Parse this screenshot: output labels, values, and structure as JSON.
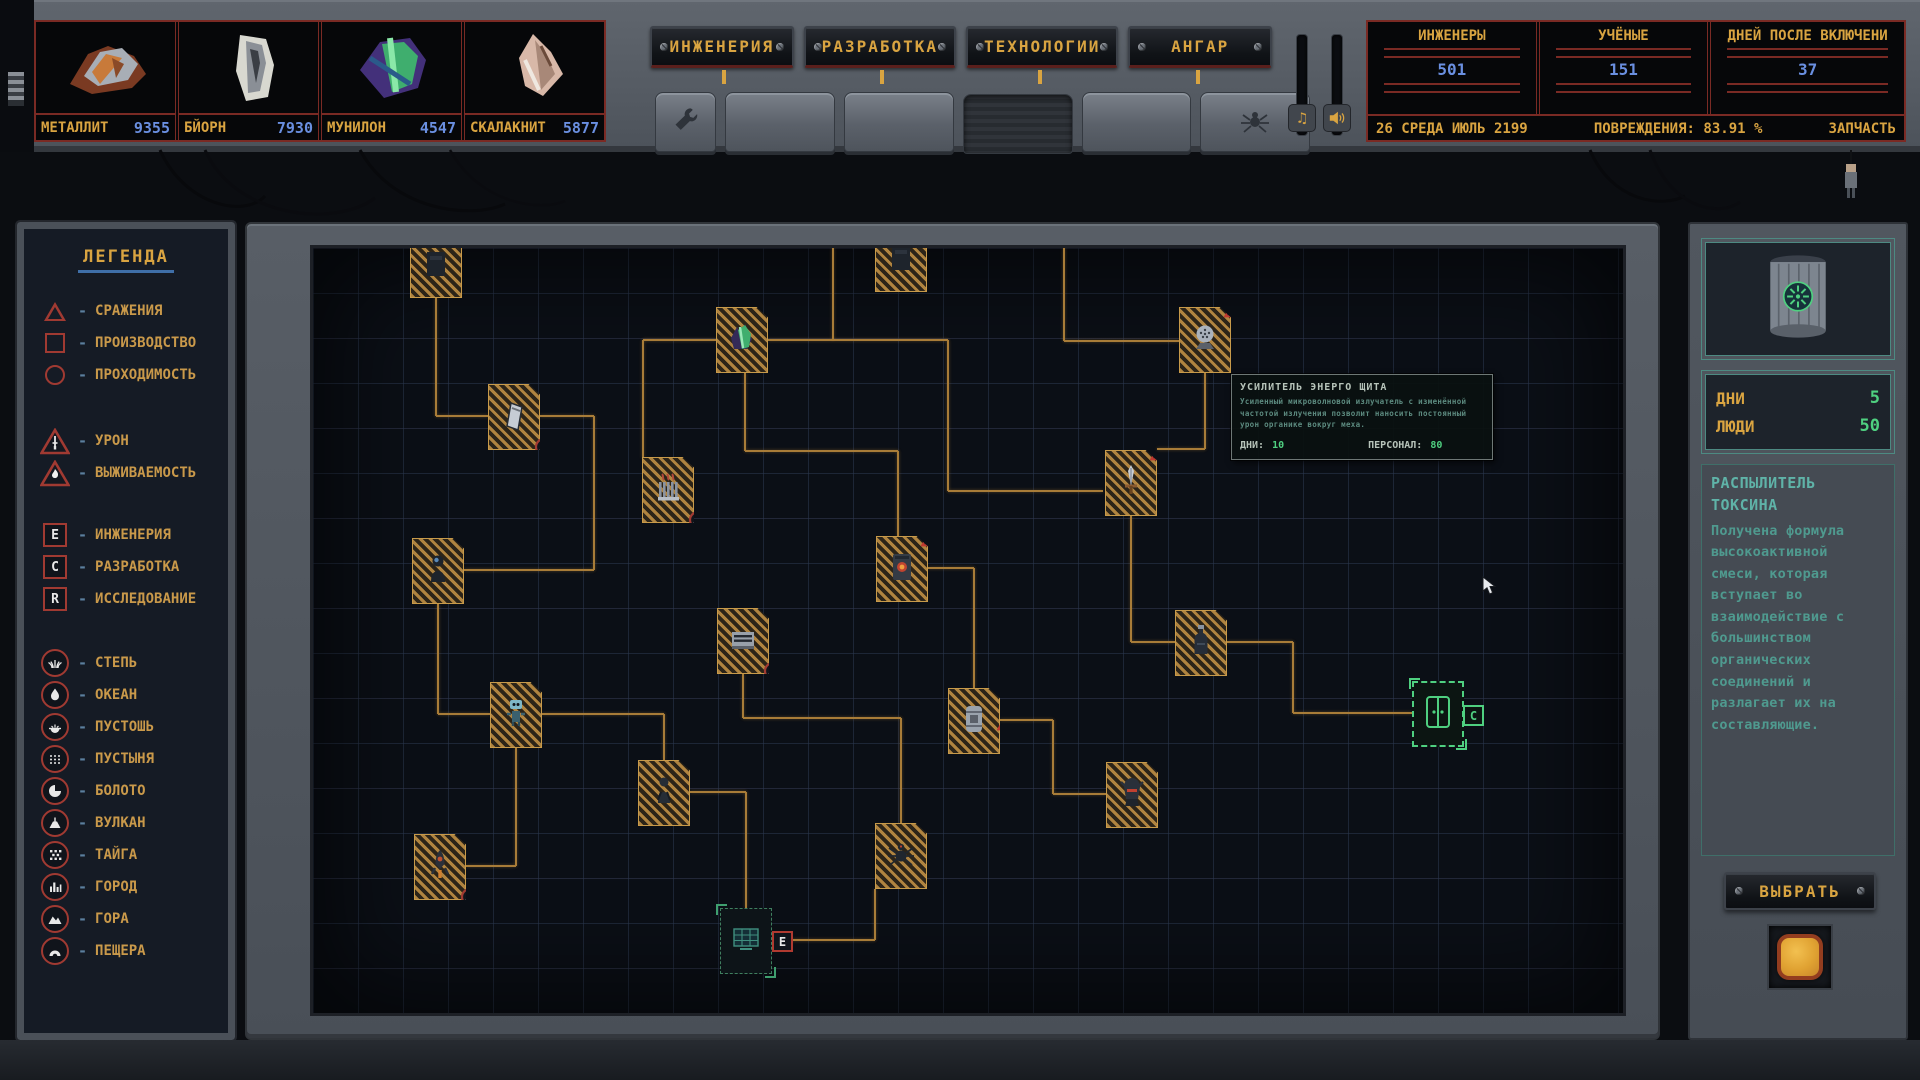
{
  "colors": {
    "accent_gold": "#d9a441",
    "value_blue": "#6a8fe0",
    "alert_red": "#a03a32",
    "teal_text": "#4f9a8f",
    "green_value": "#4fd080",
    "connector_orange": "#a87c38"
  },
  "resources": {
    "items": [
      {
        "name": "МЕТАЛЛИТ",
        "value": "9355",
        "icon": "metallit-ore-icon"
      },
      {
        "name": "БЙОРН",
        "value": "7930",
        "icon": "bjorn-ore-icon"
      },
      {
        "name": "МУНИЛОН",
        "value": "4547",
        "icon": "munilon-crystal-icon"
      },
      {
        "name": "СКАЛАКНИТ",
        "value": "5877",
        "icon": "skalaknit-shard-icon"
      }
    ]
  },
  "tabs": {
    "items": [
      {
        "label": "ИНЖЕНЕРИЯ"
      },
      {
        "label": "РАЗРАБОТКА"
      },
      {
        "label": "ТЕХНОЛОГИИ"
      },
      {
        "label": "АНГАР"
      }
    ]
  },
  "toolbar": {
    "keys": [
      {
        "icon": "wrench-icon",
        "narrow": true
      },
      {
        "icon": ""
      },
      {
        "icon": ""
      },
      {
        "icon": "",
        "pressed": true
      },
      {
        "icon": ""
      },
      {
        "icon": "spider-icon"
      }
    ]
  },
  "audio": {
    "music_icon": "music-note-icon",
    "music_glyph": "♫",
    "sfx_icon": "speaker-icon"
  },
  "stats": {
    "cols": [
      {
        "label": "ИНЖЕНЕРЫ",
        "value": "501"
      },
      {
        "label": "УЧЁНЫЕ",
        "value": "151"
      },
      {
        "label": "ДНЕЙ ПОСЛЕ ВКЛЮЧЕНИ",
        "value": "37"
      }
    ],
    "status": {
      "date": "26 СРЕДА ИЮЛЬ 2199",
      "damage_label": "ПОВРЕЖДЕНИЯ:",
      "damage_value": "83.91 %",
      "spare_label": "ЗАПЧАСТЬ"
    }
  },
  "legend": {
    "title": "ЛЕГЕНДА",
    "shape_items": [
      {
        "shape": "triangle",
        "label": "СРАЖЕНИЯ"
      },
      {
        "shape": "square",
        "label": "ПРОИЗВОДСТВО"
      },
      {
        "shape": "circle",
        "label": "ПРОХОДИМОСТЬ"
      }
    ],
    "alert_items": [
      {
        "icon": "sword-triangle-icon",
        "label": "УРОН"
      },
      {
        "icon": "flame-triangle-icon",
        "label": "ВЫЖИВАЕМОСТЬ"
      }
    ],
    "letter_items": [
      {
        "letter": "E",
        "label": "ИНЖЕНЕРИЯ"
      },
      {
        "letter": "C",
        "label": "РАЗРАБОТКА"
      },
      {
        "letter": "R",
        "label": "ИССЛЕДОВАНИЕ"
      }
    ],
    "biome_items": [
      {
        "icon": "steppe-icon",
        "label": "СТЕПЬ"
      },
      {
        "icon": "ocean-icon",
        "label": "ОКЕАН"
      },
      {
        "icon": "wasteland-icon",
        "label": "ПУСТОШЬ"
      },
      {
        "icon": "desert-icon",
        "label": "ПУСТЫНЯ"
      },
      {
        "icon": "swamp-icon",
        "label": "БОЛОТО"
      },
      {
        "icon": "volcano-icon",
        "label": "ВУЛКАН"
      },
      {
        "icon": "taiga-icon",
        "label": "ТАЙГА"
      },
      {
        "icon": "city-icon",
        "label": "ГОРОД"
      },
      {
        "icon": "mountain-icon",
        "label": "ГОРА"
      },
      {
        "icon": "cave-icon",
        "label": "ПЕЩЕРА"
      }
    ]
  },
  "map": {
    "nodes": [
      {
        "id": "node-top-module-1",
        "icon": "module",
        "x": 97,
        "y": -16,
        "badge": "none",
        "state": "normal"
      },
      {
        "id": "node-top-module-2",
        "icon": "module",
        "x": 562,
        "y": -22,
        "badge": "none",
        "state": "normal"
      },
      {
        "id": "node-crystal",
        "icon": "crystal",
        "x": 403,
        "y": 59,
        "badge": "c",
        "state": "normal"
      },
      {
        "id": "node-hatch",
        "icon": "hatch",
        "x": 175,
        "y": 136,
        "badge": "volcano",
        "state": "normal"
      },
      {
        "id": "node-radiator",
        "icon": "radiator",
        "x": 329,
        "y": 209,
        "badge": "volcano",
        "state": "normal"
      },
      {
        "id": "node-astronaut",
        "icon": "astronaut",
        "x": 99,
        "y": 290,
        "badge": "c",
        "state": "normal"
      },
      {
        "id": "node-server",
        "icon": "server",
        "x": 404,
        "y": 360,
        "badge": "volcano",
        "state": "normal"
      },
      {
        "id": "node-robot",
        "icon": "robot",
        "x": 177,
        "y": 434,
        "badge": "c",
        "state": "normal"
      },
      {
        "id": "node-worker",
        "icon": "worker",
        "x": 325,
        "y": 512,
        "badge": "e",
        "state": "normal"
      },
      {
        "id": "node-rocket",
        "icon": "rocket",
        "x": 101,
        "y": 586,
        "badge": "volcano",
        "state": "normal"
      },
      {
        "id": "node-furnace",
        "icon": "furnace",
        "x": 563,
        "y": 288,
        "badge": "warning",
        "state": "normal"
      },
      {
        "id": "node-spider-drone",
        "icon": "spider",
        "x": 562,
        "y": 575,
        "badge": "e",
        "state": "normal"
      },
      {
        "id": "node-solar-panel",
        "icon": "solar",
        "x": 407,
        "y": 660,
        "badge": "e",
        "state": "dim"
      },
      {
        "id": "node-barrel",
        "icon": "barrel",
        "x": 635,
        "y": 440,
        "badge": "warning-mid",
        "state": "normal"
      },
      {
        "id": "node-sword",
        "icon": "sword",
        "x": 792,
        "y": 202,
        "badge": "warning",
        "state": "normal"
      },
      {
        "id": "node-shield-dome",
        "icon": "dome",
        "x": 866,
        "y": 59,
        "badge": "warning",
        "state": "normal"
      },
      {
        "id": "node-armor",
        "icon": "armor",
        "x": 793,
        "y": 514,
        "badge": "c",
        "state": "normal"
      },
      {
        "id": "node-toxin-bottle",
        "icon": "bottle",
        "x": 862,
        "y": 362,
        "badge": "c",
        "state": "normal"
      },
      {
        "id": "node-door-selected",
        "icon": "door",
        "x": 1099,
        "y": 433,
        "badge": "c-green",
        "state": "selected"
      }
    ],
    "connectors": [
      [
        455,
        92,
        635,
        92
      ],
      [
        635,
        92,
        635,
        243
      ],
      [
        635,
        243,
        790,
        243
      ],
      [
        520,
        0,
        520,
        92
      ],
      [
        330,
        92,
        403,
        92
      ],
      [
        330,
        92,
        330,
        210
      ],
      [
        123,
        30,
        123,
        168
      ],
      [
        123,
        168,
        175,
        168
      ],
      [
        432,
        125,
        432,
        203
      ],
      [
        432,
        203,
        585,
        203
      ],
      [
        585,
        203,
        585,
        288
      ],
      [
        227,
        168,
        281,
        168
      ],
      [
        281,
        168,
        281,
        322
      ],
      [
        151,
        322,
        281,
        322
      ],
      [
        125,
        356,
        125,
        466
      ],
      [
        125,
        466,
        177,
        466
      ],
      [
        229,
        466,
        351,
        466
      ],
      [
        351,
        466,
        351,
        512
      ],
      [
        203,
        500,
        203,
        618
      ],
      [
        153,
        618,
        203,
        618
      ],
      [
        377,
        544,
        433,
        544
      ],
      [
        433,
        544,
        433,
        660
      ],
      [
        430,
        426,
        430,
        470
      ],
      [
        430,
        470,
        588,
        470
      ],
      [
        588,
        470,
        588,
        575
      ],
      [
        615,
        320,
        661,
        320
      ],
      [
        661,
        320,
        661,
        440
      ],
      [
        818,
        268,
        818,
        394
      ],
      [
        818,
        394,
        862,
        394
      ],
      [
        892,
        125,
        892,
        201
      ],
      [
        844,
        201,
        892,
        201
      ],
      [
        751,
        0,
        751,
        93
      ],
      [
        751,
        93,
        866,
        93
      ],
      [
        914,
        394,
        980,
        394
      ],
      [
        980,
        394,
        980,
        465
      ],
      [
        980,
        465,
        1099,
        465
      ],
      [
        687,
        472,
        740,
        472
      ],
      [
        740,
        472,
        740,
        546
      ],
      [
        740,
        546,
        793,
        546
      ],
      [
        459,
        692,
        562,
        692
      ],
      [
        562,
        641,
        562,
        692
      ]
    ]
  },
  "tooltip": {
    "title": "УСИЛИТЕЛЬ ЭНЕРГО ЩИТА",
    "body": "Усиленный микроволновой излучатель с изменённой частотой излучения позволит наносить постоянный урон органике вокруг меха.",
    "days_label": "ДНИ:",
    "days_value": "10",
    "personnel_label": "ПЕРСОНАЛ:",
    "personnel_value": "80"
  },
  "detail_panel": {
    "item_icon": "toxin-canister-icon",
    "rows": [
      {
        "label": "ДНИ",
        "value": "5"
      },
      {
        "label": "ЛЮДИ",
        "value": "50"
      }
    ],
    "title": "РАСПЫЛИТЕЛЬ ТОКСИНА",
    "description": "Получена формула высокоактивной смеси, которая вступает во взаимодействие с большинством органических соединений и разлагает их на составляющие.",
    "select_label": "ВЫБРАТЬ"
  }
}
